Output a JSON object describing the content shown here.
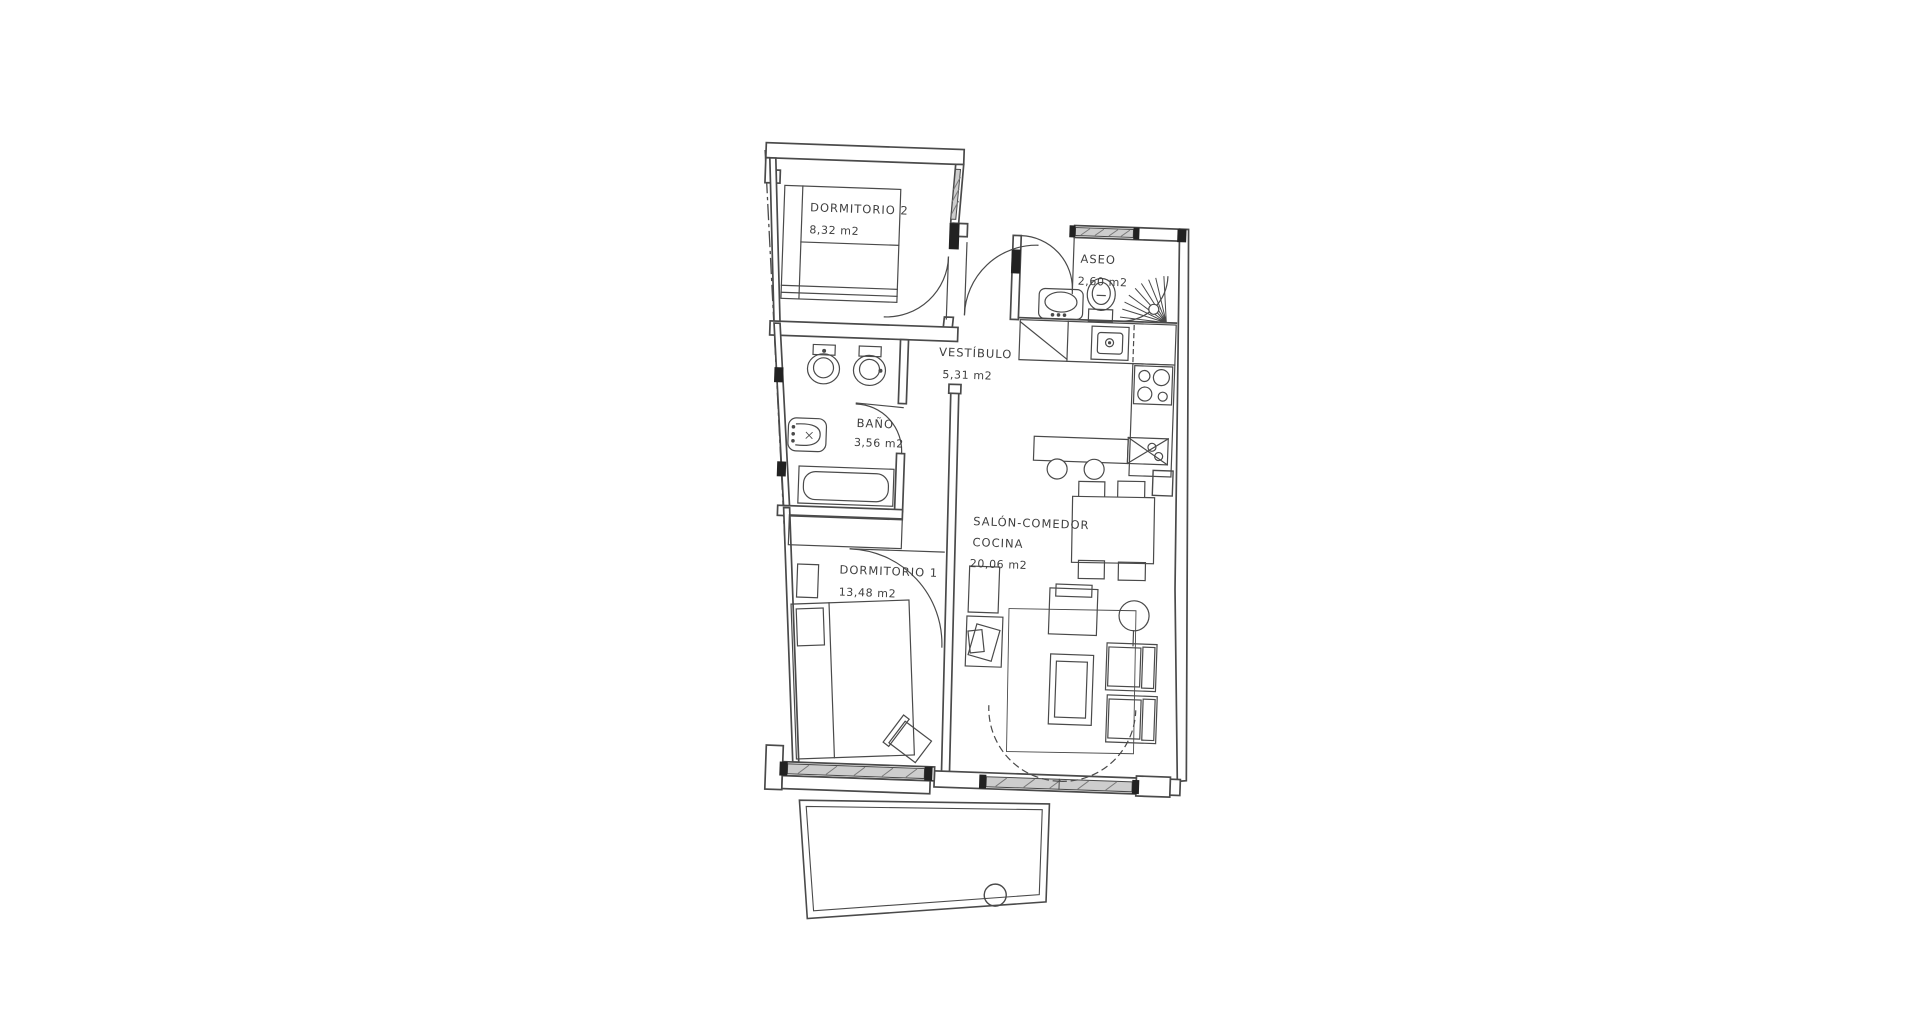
{
  "plan": {
    "rooms": [
      {
        "id": "dormitorio-2",
        "label": "DORMITORIO 2",
        "area": "8,32 m2"
      },
      {
        "id": "aseo",
        "label": "ASEO",
        "area": "2,60 m2"
      },
      {
        "id": "vestibulo",
        "label": "VESTÍBULO",
        "area": "5,31 m2"
      },
      {
        "id": "bano",
        "label": "BAÑO",
        "area": "3,56 m2"
      },
      {
        "id": "dormitorio-1",
        "label": "DORMITORIO 1",
        "area": "13,48 m2"
      },
      {
        "id": "salon-comedor-cocina",
        "label_line1": "SALÓN-COMEDOR",
        "label_line2": "COCINA",
        "area": "20,06 m2"
      }
    ],
    "colors": {
      "ink": "#4a4a4a",
      "paper": "#ffffff",
      "window_glass": "#c9c9c9",
      "jamb_fill": "#222222"
    }
  }
}
